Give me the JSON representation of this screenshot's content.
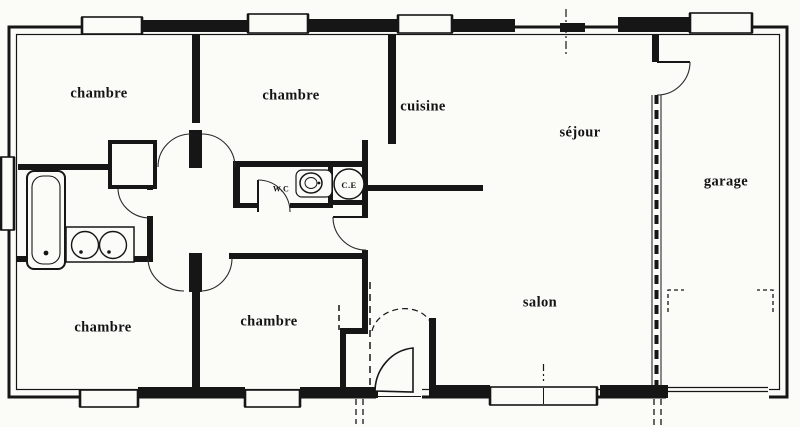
{
  "figure": {
    "kind": "house floor plan (scanned drawing)",
    "paper_color": "#fbfbf8",
    "ink_color": "#161616",
    "canvas": {
      "width": 800,
      "height": 427
    }
  },
  "rooms": [
    {
      "id": "bedroom-top-left",
      "label": "chambre",
      "x": 99,
      "y": 94,
      "size": 14.5
    },
    {
      "id": "bedroom-top-middle",
      "label": "chambre",
      "x": 291,
      "y": 96,
      "size": 14.5
    },
    {
      "id": "kitchen",
      "label": "cuisine",
      "x": 423,
      "y": 107,
      "size": 14.5
    },
    {
      "id": "living-room",
      "label": "séjour",
      "x": 580,
      "y": 133,
      "size": 14.5
    },
    {
      "id": "garage",
      "label": "garage",
      "x": 726,
      "y": 182,
      "size": 14.5
    },
    {
      "id": "lounge",
      "label": "salon",
      "x": 540,
      "y": 303,
      "size": 14.5
    },
    {
      "id": "bedroom-bottom-left",
      "label": "chambre",
      "x": 103,
      "y": 328,
      "size": 14.5
    },
    {
      "id": "bedroom-bottom-middle",
      "label": "chambre",
      "x": 269,
      "y": 322,
      "size": 14.5
    },
    {
      "id": "wc",
      "label": "W.C",
      "x": 281,
      "y": 189,
      "size": 8
    },
    {
      "id": "water-heater",
      "label": "C.E",
      "x": 349,
      "y": 185,
      "size": 8.5
    }
  ],
  "fixtures": [
    {
      "name": "bathtub",
      "x": 27,
      "y": 171,
      "w": 38,
      "h": 98
    },
    {
      "name": "double-sink-vanity",
      "x": 66,
      "y": 227,
      "w": 68,
      "h": 35,
      "sinks": [
        [
          85,
          245
        ],
        [
          113,
          245
        ]
      ],
      "r": 13.5
    },
    {
      "name": "toilet",
      "x": 296,
      "y": 170,
      "w": 36,
      "h": 27,
      "bowl": [
        311,
        183
      ]
    },
    {
      "name": "water-heater-circle",
      "cx": 349,
      "cy": 184,
      "r": 15
    },
    {
      "name": "closet",
      "x": 110,
      "y": 142,
      "w": 45,
      "h": 45
    }
  ],
  "floorplan": {
    "exterior": {
      "outer": [
        9,
        27,
        778,
        370
      ],
      "inner": [
        16.5,
        34.5,
        763,
        355
      ]
    },
    "openings": {
      "entry_door_patch": [
        376,
        380,
        46,
        19
      ],
      "garage_door_patch": [
        666,
        380,
        103,
        19
      ],
      "entry_threshold": [
        377,
        396.5,
        421,
        396.5
      ],
      "garage_door_lines": [
        [
          667,
          387.5,
          768,
          387.5
        ],
        [
          667,
          391.5,
          768,
          391.5
        ]
      ]
    },
    "walls": [
      [
        192,
        34,
        8,
        89
      ],
      [
        189,
        130,
        13,
        38
      ],
      [
        18,
        164,
        92,
        6
      ],
      [
        147,
        164,
        6,
        26
      ],
      [
        147,
        216,
        6,
        46
      ],
      [
        16,
        256,
        131,
        6
      ],
      [
        189,
        253,
        13,
        39
      ],
      [
        192,
        292,
        8,
        102
      ],
      [
        229,
        253,
        134,
        6
      ],
      [
        233,
        161,
        133,
        6
      ],
      [
        233,
        167,
        7,
        40
      ],
      [
        328,
        167,
        5,
        36
      ],
      [
        233,
        203,
        25,
        5
      ],
      [
        290,
        203,
        43,
        5
      ],
      [
        330,
        200,
        38,
        5
      ],
      [
        362,
        140,
        6,
        78
      ],
      [
        388,
        34,
        8,
        110
      ],
      [
        362,
        185,
        121,
        6
      ],
      [
        362,
        250,
        6,
        84
      ],
      [
        340,
        328,
        28,
        6
      ],
      [
        340,
        334,
        6,
        62
      ],
      [
        429,
        318,
        7,
        78
      ],
      [
        652,
        34,
        7,
        28
      ]
    ],
    "windows_outlined": [
      [
        82,
        17,
        60,
        17
      ],
      [
        248,
        14,
        60,
        19
      ],
      [
        398,
        15,
        54,
        18
      ],
      [
        690,
        13,
        62,
        20
      ],
      [
        80,
        390,
        58,
        17
      ],
      [
        245,
        390,
        55,
        17
      ],
      [
        490,
        387,
        107,
        18
      ],
      [
        1,
        157,
        13,
        73
      ]
    ],
    "windows_filled": [
      [
        142,
        20,
        111,
        12
      ],
      [
        307,
        19,
        91,
        13
      ],
      [
        452,
        19,
        63,
        13
      ],
      [
        560,
        23,
        25,
        9
      ],
      [
        618,
        17,
        72,
        15
      ],
      [
        138,
        387,
        107,
        11
      ],
      [
        300,
        387,
        78,
        11
      ],
      [
        436,
        385,
        54,
        13
      ],
      [
        600,
        385,
        68,
        13
      ]
    ],
    "bay_window_mullion": [
      543.5,
      388,
      543.5,
      404
    ],
    "door_leaves": [
      "M150,188 L118,188",
      "M258,212 L258,180",
      "M366,217 L333,217",
      "M657,62 L690,62"
    ],
    "door_arcs": [
      "M158,167 A33,33 0 0 1 191,134",
      "M202,134 A33,33 0 0 1 235,167",
      "M148,258 A36,33 0 0 0 184,291",
      "M200,291 A32,33 0 0 0 232,258",
      "M118,188 A32,30 0 0 0 150,218",
      "M258,180 A32,32 0 0 1 290,212",
      "M333,217 A33,33 0 0 0 366,250",
      "M690,62 A33,33 0 0 1 657,95"
    ],
    "entry_door_leaf": "M413,392 L413,348 A42,44 0 0 0 375,391 Z",
    "dashed_arc": "M372,331 C378,306 419,300 431,323",
    "partition_dashed": {
      "side_lines": [
        [
          652,
          95,
          652,
          388
        ],
        [
          661,
          95,
          661,
          388
        ]
      ],
      "center": [
        656.5,
        95,
        656.5,
        388
      ]
    },
    "garage_corner_brackets": [
      "M668,312 L668,290 L684,290",
      "M773,312 L773,290 L757,290"
    ],
    "dashed_lines": [
      {
        "x1": 370,
        "y1": 282,
        "x2": 370,
        "y2": 394,
        "dash": "7 5",
        "w": 1.5
      },
      {
        "x1": 339,
        "y1": 305,
        "x2": 339,
        "y2": 330,
        "dash": "6 4",
        "w": 1.5
      },
      {
        "x1": 356,
        "y1": 399,
        "x2": 356,
        "y2": 424,
        "dash": "6 4",
        "w": 1.3
      },
      {
        "x1": 363,
        "y1": 399,
        "x2": 363,
        "y2": 424,
        "dash": "6 4",
        "w": 1.3
      },
      {
        "x1": 654,
        "y1": 399,
        "x2": 654,
        "y2": 427,
        "dash": "6 4",
        "w": 1.3
      },
      {
        "x1": 661,
        "y1": 399,
        "x2": 661,
        "y2": 427,
        "dash": "6 4",
        "w": 1.3
      },
      {
        "x1": 566,
        "y1": 9,
        "x2": 566,
        "y2": 54,
        "dash": "8 3 2 3",
        "w": 1.2
      },
      {
        "x1": 543.5,
        "y1": 364,
        "x2": 543.5,
        "y2": 381,
        "dash": "7 3 2 3",
        "w": 1.2
      }
    ]
  }
}
